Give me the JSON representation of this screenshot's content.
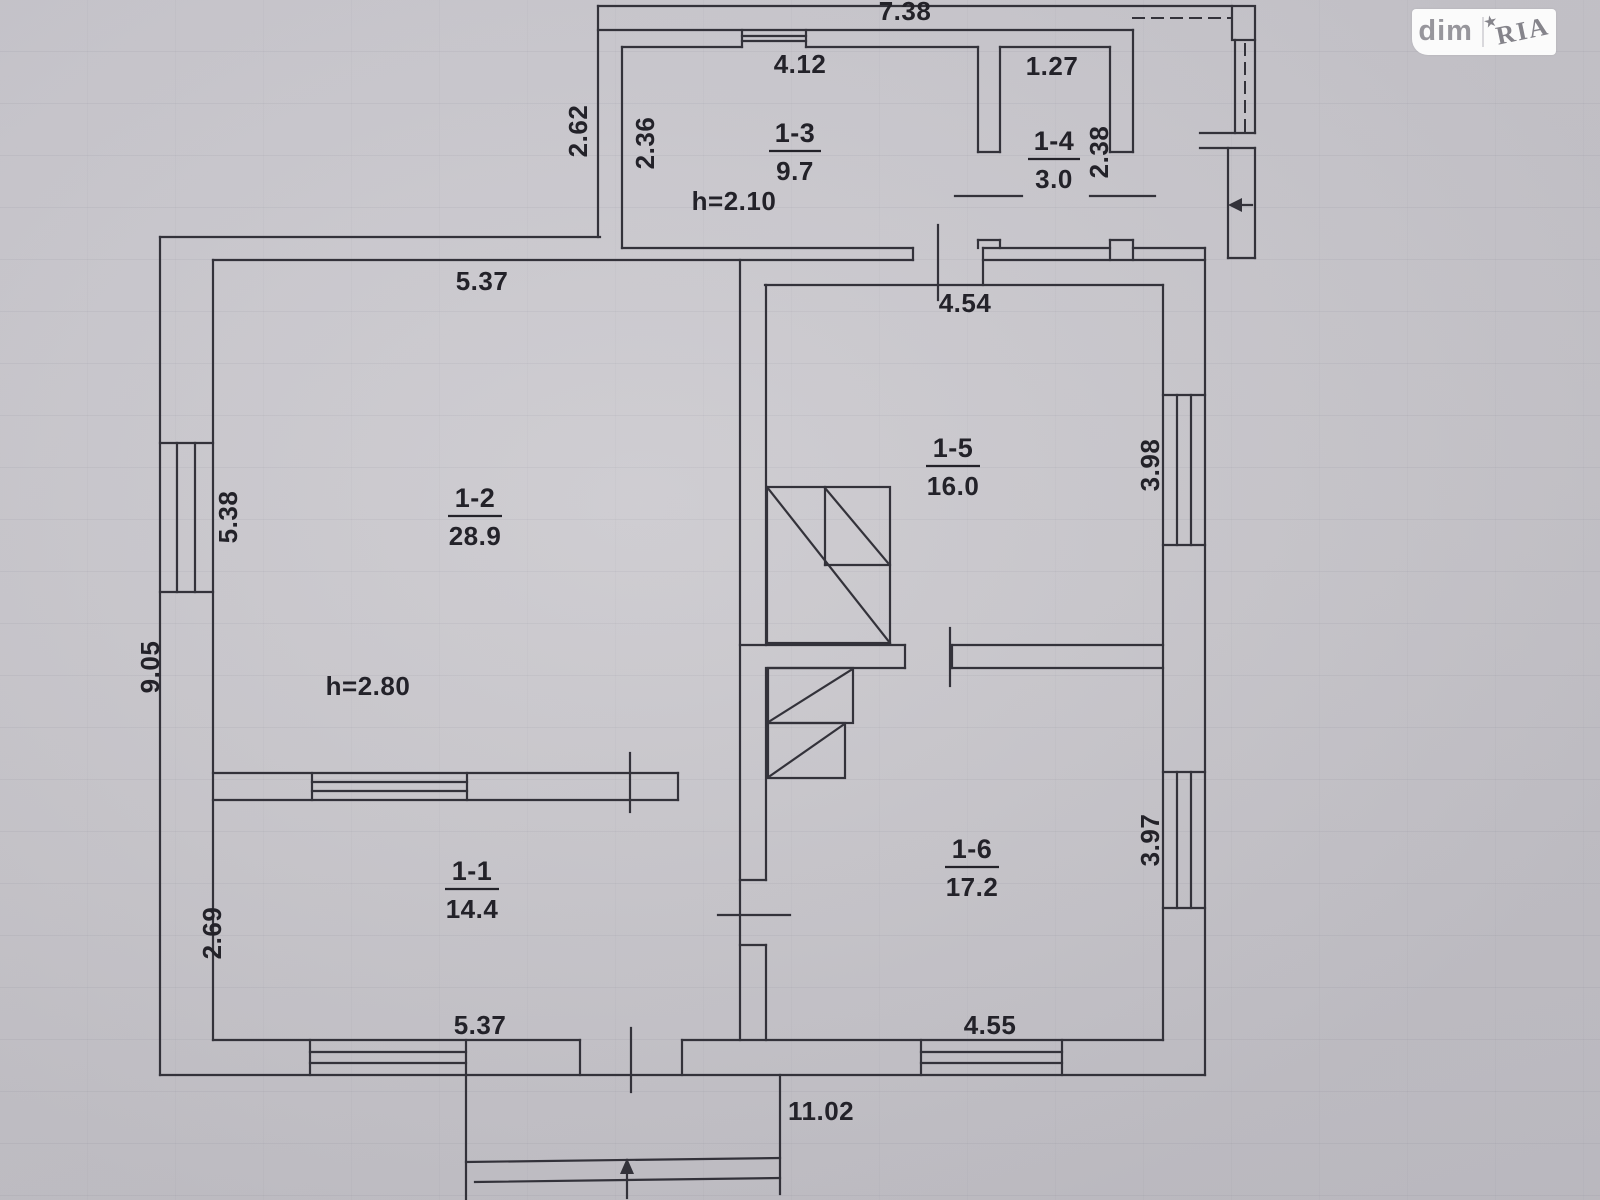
{
  "watermark": {
    "brand_left": "dim",
    "brand_right": "RIA",
    "star": "★"
  },
  "colors": {
    "paper": "#c9c7cc",
    "ink": "#33323a",
    "watermark_bg": "#ffffff",
    "watermark_text": "#97969c"
  },
  "plan": {
    "rooms": {
      "r11": {
        "id": "1-1",
        "area": "14.4"
      },
      "r12": {
        "id": "1-2",
        "area": "28.9"
      },
      "r13": {
        "id": "1-3",
        "area": "9.7"
      },
      "r14": {
        "id": "1-4",
        "area": "3.0"
      },
      "r15": {
        "id": "1-5",
        "area": "16.0"
      },
      "r16": {
        "id": "1-6",
        "area": "17.2"
      }
    },
    "heights": {
      "annex": "h=2.10",
      "main": "h=2.80"
    },
    "dims": {
      "top_total": "7.38",
      "room13_width": "4.12",
      "room13_depth": "2.36",
      "annex_offset": "2.62",
      "room14_width": "1.27",
      "room14_depth": "2.38",
      "room12_width": "5.37",
      "room12_depth": "5.38",
      "room15_width": "4.54",
      "room15_depth": "3.98",
      "left_total": "9.05",
      "room11_depth": "2.69",
      "room11_width": "5.37",
      "room16_depth": "3.97",
      "room16_width": "4.55",
      "bottom_total": "11.02"
    }
  }
}
